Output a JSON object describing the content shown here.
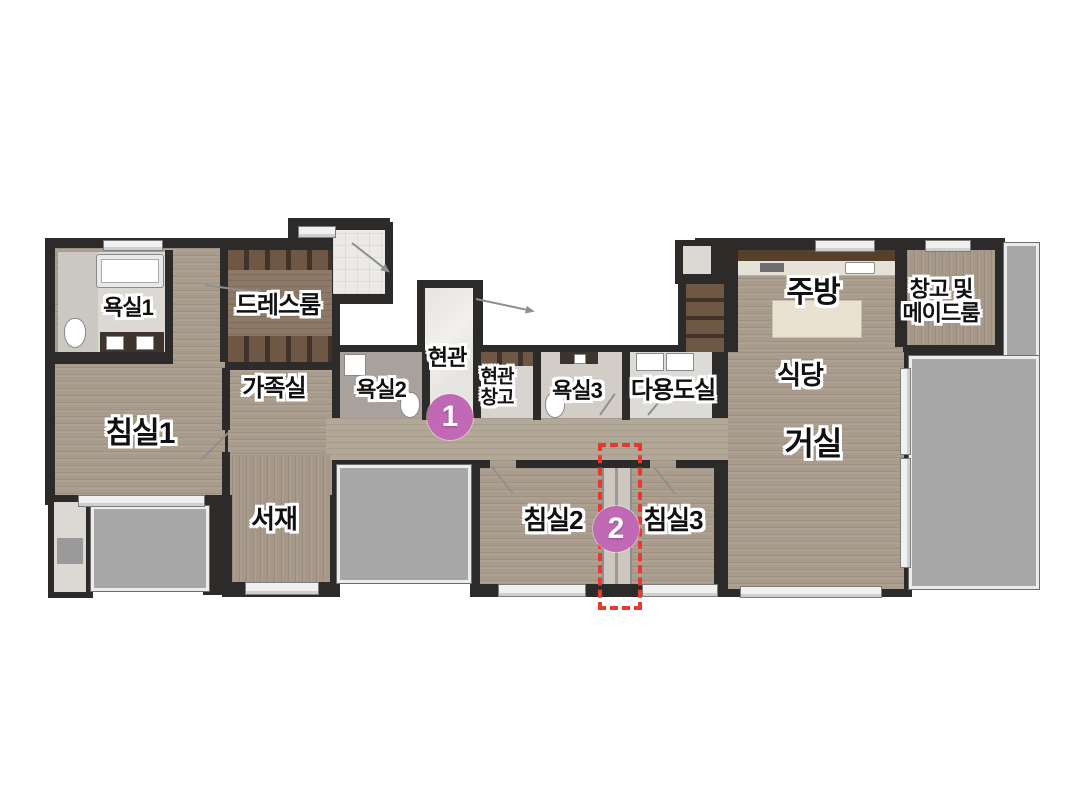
{
  "plan": {
    "rooms": {
      "bath1": "욕실1",
      "dressroom": "드레스룸",
      "family_room": "가족실",
      "bedroom1": "침실1",
      "bath2": "욕실2",
      "entrance": "현관",
      "entrance_storage_line1": "현관",
      "entrance_storage_line2": "창고",
      "bath3": "욕실3",
      "utility": "다용도실",
      "kitchen": "주방",
      "storage_maid_line1": "창고 및",
      "storage_maid_line2": "메이드룸",
      "dining": "식당",
      "living": "거실",
      "study": "서재",
      "bedroom2": "침실2",
      "bedroom3": "침실3"
    },
    "markers": [
      {
        "number": "1",
        "color": "#c169b4"
      },
      {
        "number": "2",
        "color": "#c169b4"
      }
    ],
    "highlight": {
      "style": "dashed",
      "color": "#e63a2e"
    }
  }
}
